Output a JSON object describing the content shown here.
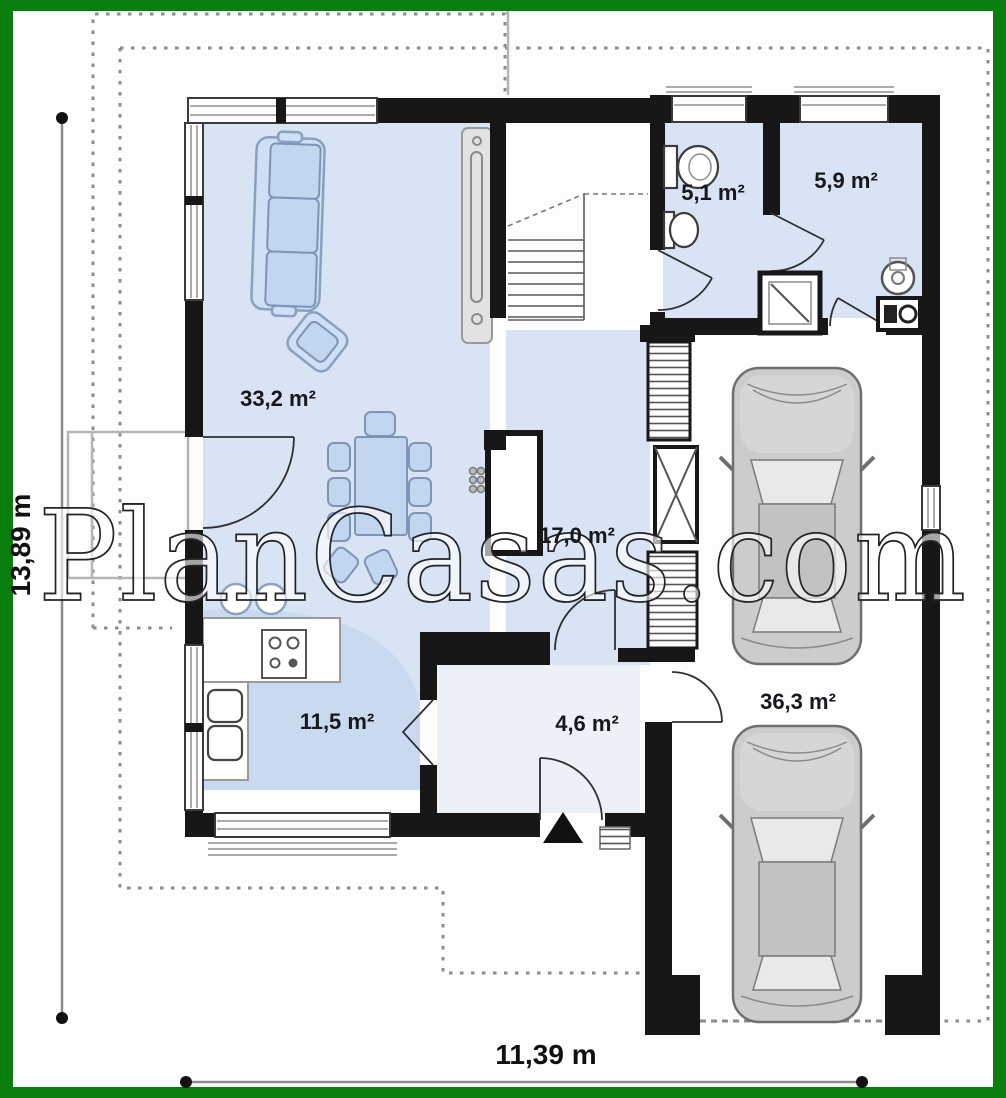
{
  "watermark": "PlanCasas.com",
  "dimensions": {
    "height": "13,89 m",
    "width": "11,39 m"
  },
  "rooms": {
    "living": {
      "label": "33,2 m²"
    },
    "wc": {
      "label": "5,1 m²"
    },
    "bath": {
      "label": "5,9 m²"
    },
    "hall": {
      "label": "17,0 m²"
    },
    "kitchen": {
      "label": "11,5 m²"
    },
    "entry": {
      "label": "4,6 m²"
    },
    "garage": {
      "label": "36,3 m²"
    }
  },
  "colors": {
    "frame_green": "#0a7d0f",
    "background": "#fdfdfd",
    "wall_black": "#171717",
    "room_blue": "#d8e3f3",
    "furniture_blue": "#cfdff4",
    "car_grey": "#cccccc",
    "watermark_white": "#ffffff"
  }
}
